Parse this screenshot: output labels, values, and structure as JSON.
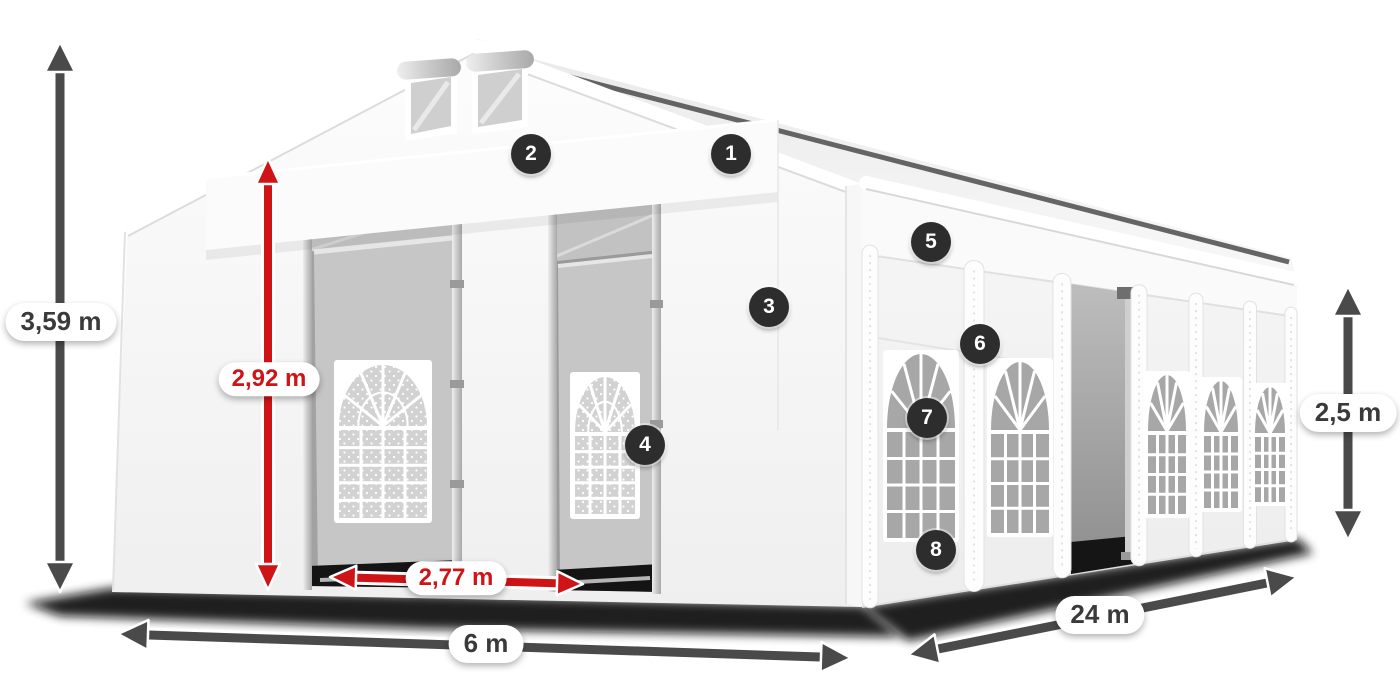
{
  "diagram": {
    "description": "White PVC marquee tent with numbered part markers and dimension arrows",
    "colors": {
      "red": "#cf1418",
      "dark_arrow": "#4a4a4a",
      "badge": "#2d2d2d",
      "pill_text": "#3a3a3a",
      "pill_bg": "#ffffff"
    },
    "dimensions": [
      {
        "id": "total-height",
        "label": "3,59 m",
        "style": "dark",
        "x": 61,
        "y": 322
      },
      {
        "id": "entrance-height",
        "label": "2,92 m",
        "style": "red",
        "x": 269,
        "y": 379
      },
      {
        "id": "entrance-width",
        "label": "2,77 m",
        "style": "red",
        "x": 456,
        "y": 578
      },
      {
        "id": "front-width",
        "label": "6 m",
        "style": "dark",
        "x": 486,
        "y": 644
      },
      {
        "id": "side-height",
        "label": "2,5 m",
        "style": "dark",
        "x": 1348,
        "y": 413
      },
      {
        "id": "length",
        "label": "24 m",
        "style": "dark",
        "x": 1100,
        "y": 615
      }
    ],
    "markers": [
      {
        "n": "1",
        "x": 731,
        "y": 154
      },
      {
        "n": "2",
        "x": 531,
        "y": 154
      },
      {
        "n": "3",
        "x": 769,
        "y": 307
      },
      {
        "n": "4",
        "x": 645,
        "y": 445
      },
      {
        "n": "5",
        "x": 931,
        "y": 242
      },
      {
        "n": "6",
        "x": 980,
        "y": 344
      },
      {
        "n": "7",
        "x": 927,
        "y": 418
      },
      {
        "n": "8",
        "x": 936,
        "y": 550
      }
    ]
  }
}
